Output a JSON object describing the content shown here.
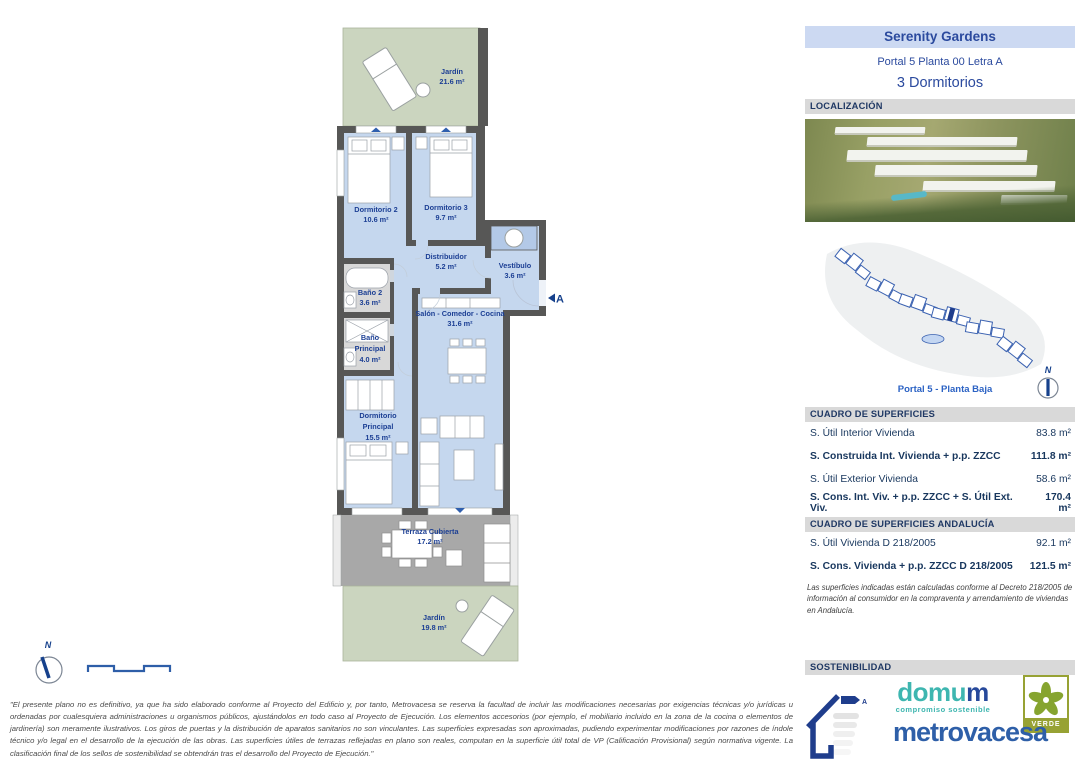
{
  "palette": {
    "accent_blue": "#2b4a9e",
    "label_navy": "#1c3f94",
    "room_blue": "#c5d7ee",
    "wall_gray": "#575756",
    "garden_green": "#cbd5bf",
    "terrace_gray": "#a8a8a8",
    "bar_gray": "#d9d9d9",
    "header_bg": "#ccd9f2",
    "domum_teal": "#3eb6b0",
    "metrovacesa_blue": "#2e5fa8",
    "verde_green": "#97a234"
  },
  "header": {
    "project": "Serenity Gardens",
    "unit": "Portal 5 Planta 00 Letra A",
    "type": "3 Dormitorios"
  },
  "section_titles": {
    "location": "LOCALIZACIÓN",
    "surfaces": "CUADRO DE SUPERFICIES",
    "surfaces_andalucia": "CUADRO DE SUPERFICIES ANDALUCÍA",
    "sustainability": "SOSTENIBILIDAD"
  },
  "siteplan": {
    "caption": "Portal 5 - Planta Baja",
    "compass_n": "N"
  },
  "surfaces": {
    "rows": [
      {
        "label": "S. Útil Interior Vivienda",
        "value": "83.8 m²"
      },
      {
        "label": "S. Construida Int. Vivienda + p.p. ZZCC",
        "value": "111.8 m²"
      },
      {
        "label": "S. Útil Exterior Vivienda",
        "value": "58.6 m²"
      },
      {
        "label": "S. Cons. Int. Viv. + p.p. ZZCC + S. Útil Ext. Viv.",
        "value": "170.4 m²"
      }
    ]
  },
  "surfaces_andalucia": {
    "rows": [
      {
        "label": "S. Útil Vivienda D 218/2005",
        "value": "92.1 m²"
      },
      {
        "label": "S. Cons. Vivienda + p.p. ZZCC D 218/2005",
        "value": "121.5 m²"
      }
    ],
    "note": "Las superficies indicadas están calculadas conforme al Decreto 218/2005 de información al consumidor en la compraventa y arrendamiento de viviendas en Andalucía."
  },
  "floorplan": {
    "compass_n": "N",
    "entrance_label": "A",
    "rooms": {
      "jardin_top": {
        "name": "Jardín",
        "area": "21.6 m²"
      },
      "dormitorio2": {
        "name": "Dormitorio 2",
        "area": "10.6 m²"
      },
      "dormitorio3": {
        "name": "Dormitorio 3",
        "area": "9.7 m²"
      },
      "distribuidor": {
        "name": "Distribuidor",
        "area": "5.2 m²"
      },
      "vestibulo": {
        "name": "Vestíbulo",
        "area": "3.6 m²"
      },
      "bano2": {
        "name": "Baño 2",
        "area": "3.6 m²"
      },
      "bano_principal": {
        "name": "Baño",
        "name2": "Principal",
        "area": "4.0 m²"
      },
      "salon": {
        "name": "Salón - Comedor - Cocina",
        "area": "31.6 m²"
      },
      "dormitorio_principal": {
        "name": "Dormitorio",
        "name2": "Principal",
        "area": "15.5 m²"
      },
      "terraza": {
        "name": "Terraza Cubierta",
        "area": "17.2 m²"
      },
      "jardin_bottom": {
        "name": "Jardín",
        "area": "19.8 m²"
      }
    }
  },
  "sustainability": {
    "energy_rating": "A",
    "domum_part1": "domu",
    "domum_part2": "m",
    "domum_tagline": "compromiso sostenible",
    "metrovacesa": "metrovacesa",
    "verde": "VERDE"
  },
  "footer": {
    "disclaimer": "\"El presente plano no es definitivo, ya que ha sido elaborado conforme al Proyecto del Edificio y, por tanto, Metrovacesa se reserva la facultad de incluir las modificaciones necesarias por exigencias técnicas y/o jurídicas u ordenadas por cualesquiera administraciones u organismos públicos, ajustándolos en todo caso al Proyecto de Ejecución. Los elementos accesorios (por ejemplo, el mobiliario incluido en la zona de la cocina o elementos de jardinería) son meramente ilustrativos. Los giros de puertas y la distribución de aparatos sanitarios no son vinculantes. Las superficies expresadas son aproximadas, pudiendo experimentar modificaciones por razones de índole técnico y/o legal en el desarrollo de la ejecución de las obras. Las superficies útiles de terrazas reflejadas en plano son reales, computan en la superficie útil total de VP (Calificación Provisional) según normativa vigente. La clasificación final de los sellos de sostenibilidad se obtendrán tras el desarrollo del Proyecto de Ejecución.\""
  }
}
